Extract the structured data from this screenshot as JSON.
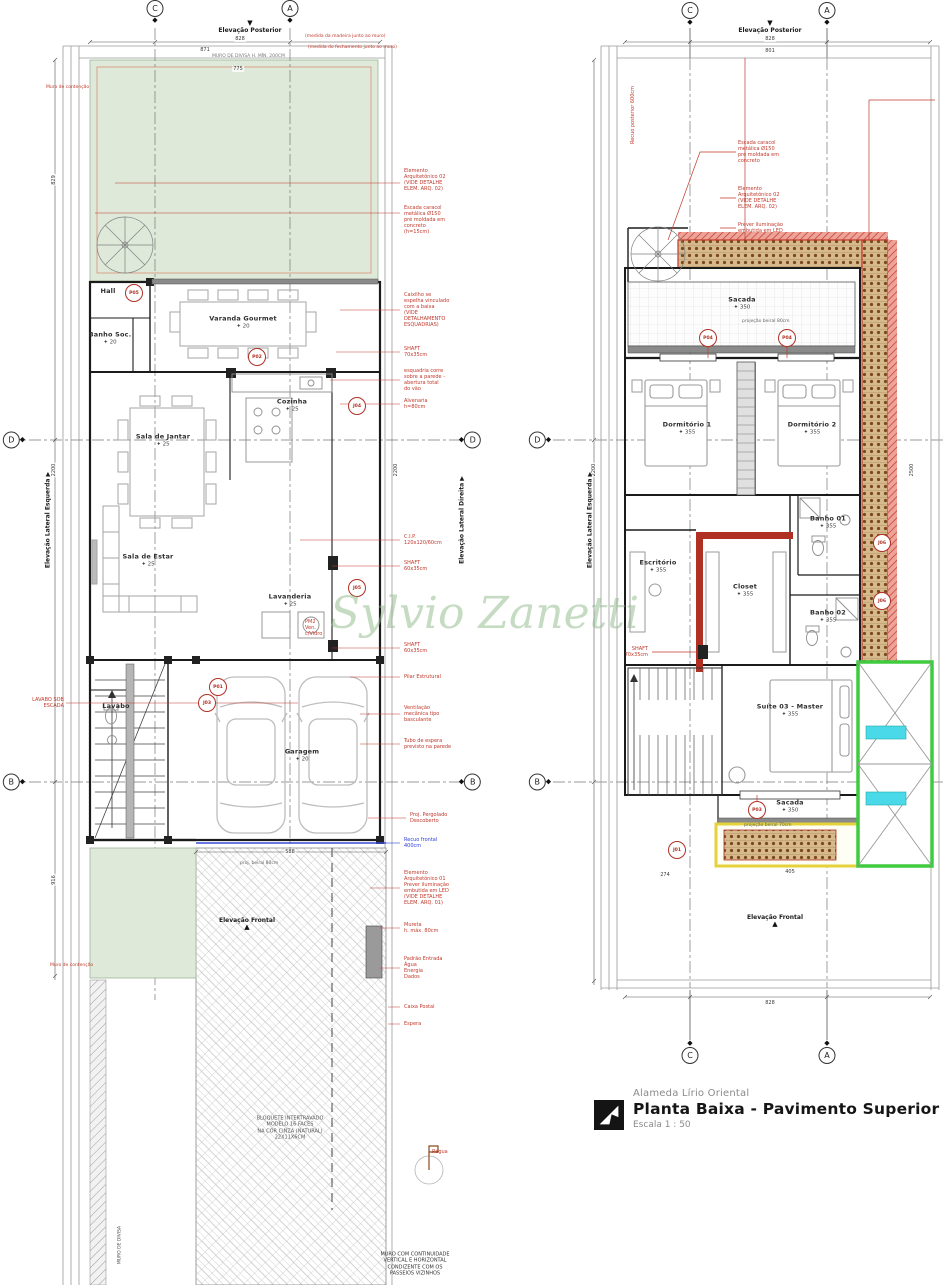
{
  "title_block": {
    "project": "Alameda Lírio Oriental",
    "title": "Planta Baixa - Pavimento Superior",
    "scale": "Escala  1 : 50"
  },
  "watermark": "Sylvio Zanetti",
  "colors": {
    "annotation": "#c0392b",
    "recuo_blue": "#2b3fd4",
    "green_area": "#dfe9da",
    "planter_border": "#c0392b",
    "highlight_green": "#3ecb3e",
    "highlight_yellow": "#e3d23c",
    "highlight_cyan": "#49d9e9",
    "watermark_green": "#8cb987"
  },
  "overlay": {
    "rooms": [
      {
        "name": "Hall",
        "x": 108,
        "y": 291
      },
      {
        "name": "Banho Soc.",
        "x": 110,
        "y": 338,
        "level": "20"
      },
      {
        "name": "Varanda Gourmet",
        "x": 243,
        "y": 322,
        "level": "20"
      },
      {
        "name": "Sala de Jantar",
        "x": 163,
        "y": 440,
        "level": "25"
      },
      {
        "name": "Cozinha",
        "x": 292,
        "y": 405,
        "level": "25"
      },
      {
        "name": "Sala de Estar",
        "x": 148,
        "y": 560,
        "level": "25"
      },
      {
        "name": "Lavanderia",
        "x": 290,
        "y": 600,
        "level": "25"
      },
      {
        "name": "Lavabo",
        "x": 116,
        "y": 706
      },
      {
        "name": "Garagem",
        "x": 302,
        "y": 755,
        "level": "20"
      },
      {
        "name": "Sacada",
        "x": 742,
        "y": 303,
        "level": "350"
      },
      {
        "name": "Dormitório 1",
        "x": 687,
        "y": 428,
        "level": "355"
      },
      {
        "name": "Dormitório 2",
        "x": 812,
        "y": 428,
        "level": "355"
      },
      {
        "name": "Escritório",
        "x": 658,
        "y": 566,
        "level": "355"
      },
      {
        "name": "Closet",
        "x": 745,
        "y": 590,
        "level": "355"
      },
      {
        "name": "Banho 01",
        "x": 828,
        "y": 522,
        "level": "355"
      },
      {
        "name": "Banho 02",
        "x": 828,
        "y": 616,
        "level": "355"
      },
      {
        "name": "Suíte 03 - Master",
        "x": 790,
        "y": 710,
        "level": "355"
      },
      {
        "name": "Sacada",
        "x": 790,
        "y": 806,
        "level": "350"
      }
    ],
    "callouts": [
      {
        "x": 404,
        "y": 180,
        "text": "Elemento\nArquitetônico 02\n(VIDE DETALHE\nELEM. ARQ. 02)"
      },
      {
        "x": 404,
        "y": 220,
        "text": "Escada caracol\nmetálica Ø150\npré moldada em\nconcreto\n(h=15cm)"
      },
      {
        "x": 404,
        "y": 310,
        "text": "Caixilho se\nespelha vinculado\ncom a baixa\n(VIDE\nDETALHAMENTO\nESQUADRIAS)"
      },
      {
        "x": 404,
        "y": 352,
        "text": "SHAFT\n70x35cm"
      },
      {
        "x": 404,
        "y": 380,
        "text": "esquadria corre\nsobre a parede -\nabertura total\ndo vão"
      },
      {
        "x": 404,
        "y": 404,
        "text": "Alvenaria\nh=80cm"
      },
      {
        "x": 404,
        "y": 540,
        "text": "C.I.P.\n120x120/60cm"
      },
      {
        "x": 404,
        "y": 566,
        "text": "SHAFT\n60x35cm"
      },
      {
        "x": 404,
        "y": 648,
        "text": "SHAFT\n60x35cm"
      },
      {
        "x": 404,
        "y": 677,
        "text": "Pilar Estrutural"
      },
      {
        "x": 404,
        "y": 714,
        "text": "Ventilação\nmecânica tipo\nbasculante"
      },
      {
        "x": 404,
        "y": 744,
        "text": "Tubo de espera\nprevisto na parede"
      },
      {
        "x": 410,
        "y": 818,
        "text": "Proj. Pergolado\nDescoberto"
      },
      {
        "x": 404,
        "y": 843,
        "text": "Recuo frontal\n400cm",
        "color": "#2b3fd4"
      },
      {
        "x": 404,
        "y": 888,
        "text": "Elemento\nArquitetônico 01\nPrever iluminação\nembutida em LED\n(VIDE DETALHE\nELEM. ARQ. 01)"
      },
      {
        "x": 404,
        "y": 928,
        "text": "Mureta\nh. máx. 80cm"
      },
      {
        "x": 404,
        "y": 968,
        "text": "Padrão Entrada\nÁgua\nEnergia\nDados"
      },
      {
        "x": 404,
        "y": 1007,
        "text": "Caixa Postal"
      },
      {
        "x": 404,
        "y": 1024,
        "text": "Espera"
      },
      {
        "x": 64,
        "y": 703,
        "text": "LAVABO SOB\nESCADA",
        "align": "right"
      },
      {
        "x": 305,
        "y": 628,
        "text": "PM2\nVen.\nc/Vidro"
      },
      {
        "x": 738,
        "y": 152,
        "text": "Escada caracol\nmetálica Ø150\npré moldada em\nconcreto"
      },
      {
        "x": 738,
        "y": 198,
        "text": "Elemento\nArquitetônico 02\n(VIDE DETALHE\nELEM. ARQ. 02)"
      },
      {
        "x": 738,
        "y": 228,
        "text": "Prever iluminação\nembutida em LED"
      },
      {
        "x": 648,
        "y": 652,
        "text": "SHAFT\n70x35cm",
        "align": "right"
      },
      {
        "x": 604,
        "y": 115,
        "text": "Recuo posterior 600cm",
        "rot": -90
      },
      {
        "x": 432,
        "y": 1152,
        "text": "Régua"
      }
    ],
    "texts": [
      {
        "x": 290,
        "y": 1128,
        "text": "BLOQUETE INTERTRAVADO\nMODELO 16 FACES\nNA COR CINZA (NATURAL)\n22X11X6CM",
        "color": "#555",
        "align": "center"
      },
      {
        "x": 415,
        "y": 1264,
        "text": "MURO COM CONTINUIDADE\nVERTICAL E HORIZONTAL\nCONDIZENTE COM OS\nPASSEIOS VIZINHOS",
        "color": "#333",
        "align": "center"
      },
      {
        "x": 212,
        "y": 57,
        "text": "MURO DE DIVISA H. MÍN. 200CM",
        "color": "#777",
        "size": 4.5
      },
      {
        "x": 305,
        "y": 37,
        "text": "(medida da madeira junto ao muro)",
        "color": "#c0392b",
        "size": 4.5
      },
      {
        "x": 308,
        "y": 48,
        "text": "(medida do fechamento junto ao muro)",
        "color": "#c0392b",
        "size": 4.5
      },
      {
        "x": 240,
        "y": 864,
        "text": "proj. beiral 80cm",
        "color": "#666",
        "size": 4.5
      },
      {
        "x": 742,
        "y": 322,
        "text": "projeção beiral 80cm",
        "color": "#666",
        "size": 4.5
      },
      {
        "x": 744,
        "y": 826,
        "text": "projeção beiral 70cm",
        "color": "#666",
        "size": 4.5
      },
      {
        "x": 46,
        "y": 88,
        "text": "Muro de contenção",
        "color": "#c0392b",
        "size": 4.5
      },
      {
        "x": 50,
        "y": 966,
        "text": "Muro de contenção",
        "color": "#c0392b",
        "size": 4.5
      },
      {
        "x": 101,
        "y": 1245,
        "text": "MURO DE DIVISA",
        "color": "#444",
        "size": 4.5,
        "rot": -90
      }
    ],
    "dims": [
      {
        "t": "828",
        "x": 240,
        "y": 39
      },
      {
        "t": "871",
        "x": 205,
        "y": 50
      },
      {
        "t": "775",
        "x": 238,
        "y": 69
      },
      {
        "t": "2200",
        "x": 54,
        "y": 470,
        "rot": -90
      },
      {
        "t": "829",
        "x": 54,
        "y": 180,
        "rot": -90
      },
      {
        "t": "916",
        "x": 54,
        "y": 880,
        "rot": -90
      },
      {
        "t": "2200",
        "x": 396,
        "y": 470,
        "rot": -90
      },
      {
        "t": "588",
        "x": 290,
        "y": 852
      },
      {
        "t": "828",
        "x": 770,
        "y": 39
      },
      {
        "t": "801",
        "x": 770,
        "y": 51
      },
      {
        "t": "828",
        "x": 770,
        "y": 1003
      },
      {
        "t": "2200",
        "x": 594,
        "y": 470,
        "rot": -90
      },
      {
        "t": "2500",
        "x": 912,
        "y": 470,
        "rot": -90
      },
      {
        "t": "405",
        "x": 790,
        "y": 872
      },
      {
        "t": "274",
        "x": 665,
        "y": 875
      }
    ],
    "grids": [
      {
        "l": "C",
        "x": 155,
        "y": 12,
        "dir": "down"
      },
      {
        "l": "A",
        "x": 290,
        "y": 12,
        "dir": "down"
      },
      {
        "l": "C",
        "x": 690,
        "y": 14,
        "dir": "down"
      },
      {
        "l": "A",
        "x": 827,
        "y": 14,
        "dir": "down"
      },
      {
        "l": "C",
        "x": 690,
        "y": 1052,
        "dir": "up"
      },
      {
        "l": "A",
        "x": 827,
        "y": 1052,
        "dir": "up"
      },
      {
        "l": "D",
        "x": 14,
        "y": 440,
        "dir": "right"
      },
      {
        "l": "D",
        "x": 470,
        "y": 440,
        "dir": "left"
      },
      {
        "l": "B",
        "x": 14,
        "y": 782,
        "dir": "right"
      },
      {
        "l": "B",
        "x": 470,
        "y": 782,
        "dir": "left"
      },
      {
        "l": "D",
        "x": 540,
        "y": 440,
        "dir": "right"
      },
      {
        "l": "B",
        "x": 540,
        "y": 782,
        "dir": "right"
      }
    ],
    "tags": [
      {
        "t": "P05",
        "x": 134,
        "y": 293
      },
      {
        "t": "P02",
        "x": 257,
        "y": 357
      },
      {
        "t": "J04",
        "x": 357,
        "y": 406
      },
      {
        "t": "J05",
        "x": 357,
        "y": 588
      },
      {
        "t": "P01",
        "x": 218,
        "y": 687
      },
      {
        "t": "J03",
        "x": 207,
        "y": 703
      },
      {
        "t": "P04",
        "x": 708,
        "y": 338
      },
      {
        "t": "P04",
        "x": 787,
        "y": 338
      },
      {
        "t": "P03",
        "x": 757,
        "y": 810
      },
      {
        "t": "J06",
        "x": 882,
        "y": 543
      },
      {
        "t": "J06",
        "x": 882,
        "y": 601
      },
      {
        "t": "J01",
        "x": 677,
        "y": 850
      }
    ],
    "elevations": [
      {
        "text": "Elevação Posterior",
        "x": 250,
        "y": 27,
        "tri": "down"
      },
      {
        "text": "Elevação Posterior",
        "x": 770,
        "y": 27,
        "tri": "down"
      },
      {
        "text": "Elevação Frontal",
        "x": 247,
        "y": 924,
        "tri": "up"
      },
      {
        "text": "Elevação Frontal",
        "x": 775,
        "y": 921,
        "tri": "up"
      },
      {
        "text": "Elevação Lateral Esquerda",
        "x": 48,
        "y": 520,
        "rot": -90,
        "tri": "r"
      },
      {
        "text": "Elevação Lateral Direita",
        "x": 462,
        "y": 520,
        "rot": -90,
        "tri": "r"
      },
      {
        "text": "Elevação Lateral Esquerda",
        "x": 590,
        "y": 520,
        "rot": -90,
        "tri": "r"
      }
    ]
  }
}
